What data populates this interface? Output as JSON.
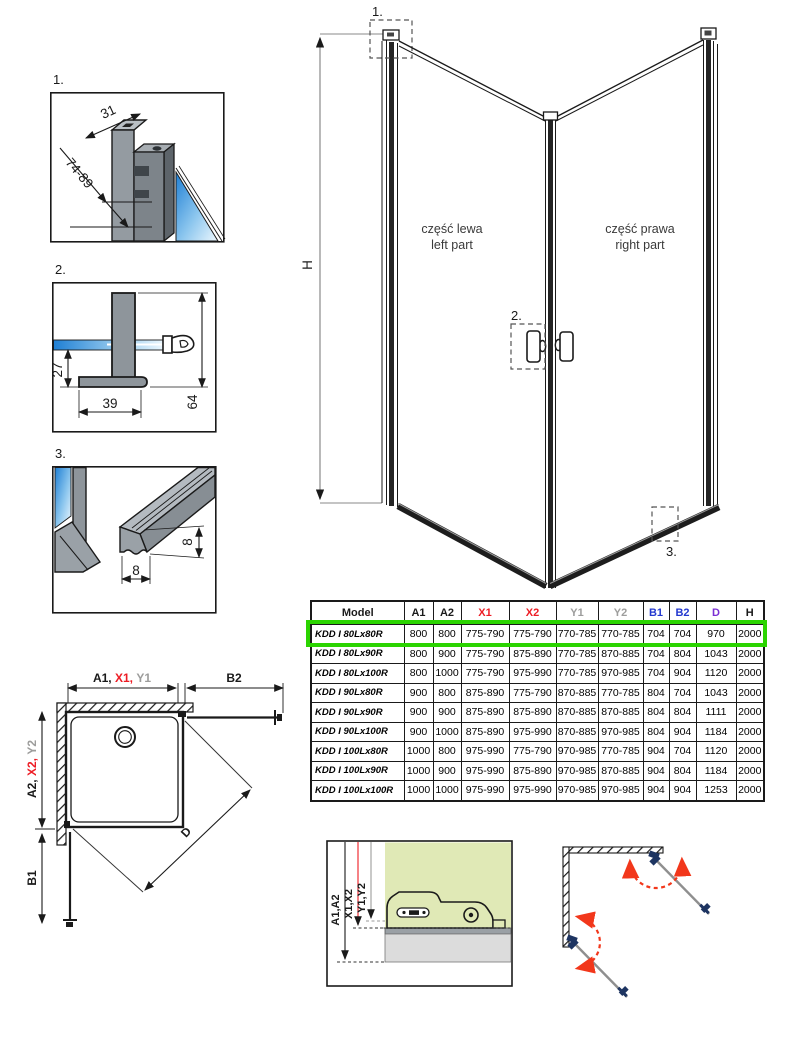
{
  "colors": {
    "red": "#ed1c24",
    "gray": "#9d9d9c",
    "blue": "#2338cf",
    "purple": "#7b2fd4",
    "green": "#2bd400"
  },
  "details": {
    "d1": {
      "label": "1.",
      "dim_top": "31",
      "dim_side": "74-89"
    },
    "d2": {
      "label": "2.",
      "dim_drop": "27",
      "dim_foot": "39",
      "dim_total": "64"
    },
    "d3": {
      "label": "3.",
      "dim_v": "8",
      "dim_h": "8"
    }
  },
  "main_view": {
    "h_label": "H",
    "marker_1": "1.",
    "marker_2": "2.",
    "marker_3": "3.",
    "left_pl": "część lewa",
    "left_en": "left part",
    "right_pl": "część prawa",
    "right_en": "right part"
  },
  "top_view": {
    "a1": "A1, ",
    "x1": "X1, ",
    "y1": "Y1",
    "b2": "B2",
    "a2": "A2, ",
    "x2": "X2, ",
    "y2": "Y2",
    "b1": "B1",
    "d": "D"
  },
  "install_view": {
    "a": "A1,A2",
    "x": "X1,X2",
    "y": "Y1,Y2"
  },
  "table": {
    "headers": [
      {
        "label": "Model",
        "color": "#1a1a1a"
      },
      {
        "label": "A1",
        "color": "#1a1a1a"
      },
      {
        "label": "A2",
        "color": "#1a1a1a"
      },
      {
        "label": "X1",
        "color": "#ed1c24"
      },
      {
        "label": "X2",
        "color": "#ed1c24"
      },
      {
        "label": "Y1",
        "color": "#9d9d9c"
      },
      {
        "label": "Y2",
        "color": "#9d9d9c"
      },
      {
        "label": "B1",
        "color": "#2338cf"
      },
      {
        "label": "B2",
        "color": "#2338cf"
      },
      {
        "label": "D",
        "color": "#7b2fd4"
      },
      {
        "label": "H",
        "color": "#1a1a1a"
      }
    ],
    "col_widths": [
      93,
      29,
      28,
      48,
      47,
      42,
      45,
      26,
      27,
      40,
      28
    ],
    "rows": [
      [
        "KDD I 80Lx80R",
        "800",
        "800",
        "775-790",
        "775-790",
        "770-785",
        "770-785",
        "704",
        "704",
        "970",
        "2000"
      ],
      [
        "KDD I 80Lx90R",
        "800",
        "900",
        "775-790",
        "875-890",
        "770-785",
        "870-885",
        "704",
        "804",
        "1043",
        "2000"
      ],
      [
        "KDD I 80Lx100R",
        "800",
        "1000",
        "775-790",
        "975-990",
        "770-785",
        "970-985",
        "704",
        "904",
        "1120",
        "2000"
      ],
      [
        "KDD I 90Lx80R",
        "900",
        "800",
        "875-890",
        "775-790",
        "870-885",
        "770-785",
        "804",
        "704",
        "1043",
        "2000"
      ],
      [
        "KDD I 90Lx90R",
        "900",
        "900",
        "875-890",
        "875-890",
        "870-885",
        "870-885",
        "804",
        "804",
        "1111",
        "2000"
      ],
      [
        "KDD I 90Lx100R",
        "900",
        "1000",
        "875-890",
        "975-990",
        "870-885",
        "970-985",
        "804",
        "904",
        "1184",
        "2000"
      ],
      [
        "KDD I 100Lx80R",
        "1000",
        "800",
        "975-990",
        "775-790",
        "970-985",
        "770-785",
        "904",
        "704",
        "1120",
        "2000"
      ],
      [
        "KDD I 100Lx90R",
        "1000",
        "900",
        "975-990",
        "875-890",
        "970-985",
        "870-885",
        "904",
        "804",
        "1184",
        "2000"
      ],
      [
        "KDD I 100Lx100R",
        "1000",
        "1000",
        "975-990",
        "975-990",
        "970-985",
        "970-985",
        "904",
        "904",
        "1253",
        "2000"
      ]
    ],
    "highlighted_row": 0,
    "highlight_color": "#2bd400"
  }
}
